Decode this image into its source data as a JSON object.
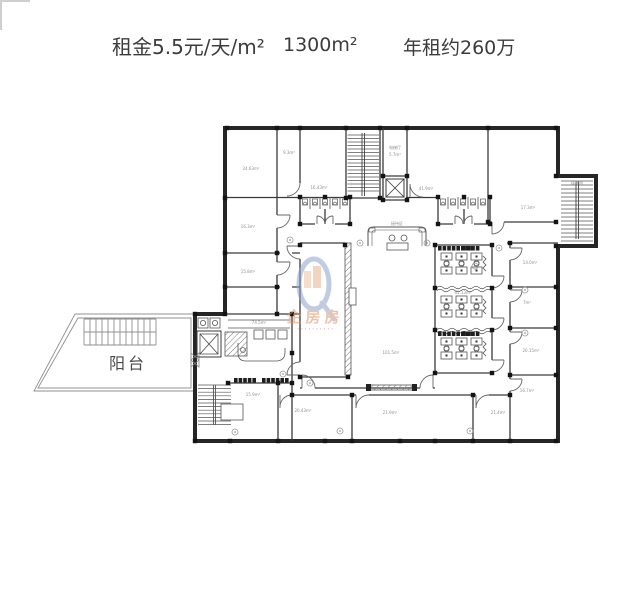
{
  "header": {
    "rent": "租金5.5元/天/m²",
    "area": "1300m²",
    "annual_rent": "年租约260万"
  },
  "floorplan": {
    "balcony_label": "阳台",
    "watermark": {
      "brand": "企房房",
      "subtext": "∙ ∙ ∙ ∙ ∙ ∙ ∙ ∙ ∙ ∙"
    },
    "area_labels": [
      {
        "t": "24.63m²",
        "x": 251,
        "y": 170
      },
      {
        "t": "9.3m²",
        "x": 289,
        "y": 154
      },
      {
        "t": "16.43m²",
        "x": 319,
        "y": 189
      },
      {
        "t": "16.3m²",
        "x": 248,
        "y": 228
      },
      {
        "t": "15.8m²",
        "x": 248,
        "y": 273
      },
      {
        "t": "电梯厅",
        "x": 395,
        "y": 149
      },
      {
        "t": "5.7m²",
        "x": 395,
        "y": 156
      },
      {
        "t": "41.9m²",
        "x": 426,
        "y": 190
      },
      {
        "t": "17.3m²",
        "x": 528,
        "y": 209
      },
      {
        "t": "楼梯间",
        "x": 577,
        "y": 184
      },
      {
        "t": "接待区",
        "x": 397,
        "y": 225
      },
      {
        "t": "61.13m²",
        "x": 463,
        "y": 294
      },
      {
        "t": "101.5m²",
        "x": 391,
        "y": 354
      },
      {
        "t": "14.0m²",
        "x": 530,
        "y": 264
      },
      {
        "t": "7m²",
        "x": 527,
        "y": 304
      },
      {
        "t": "20.15m²",
        "x": 531,
        "y": 352
      },
      {
        "t": "16.7m²",
        "x": 527,
        "y": 392
      },
      {
        "t": "15.9m²",
        "x": 253,
        "y": 396
      },
      {
        "t": "20.43m²",
        "x": 303,
        "y": 412
      },
      {
        "t": "21.9m²",
        "x": 390,
        "y": 414
      },
      {
        "t": "21.4m²",
        "x": 498,
        "y": 414
      },
      {
        "t": "74.5m²",
        "x": 259,
        "y": 324
      }
    ]
  },
  "colors": {
    "outer_wall": "#262626",
    "inner_wall": "#3a3a3a",
    "annotation": "#8f8f8f",
    "watermark_blue": "#8fa2cc",
    "watermark_orange": "#e09467",
    "watermark_red": "#c85f50",
    "header_text": "#3c3c3c"
  }
}
